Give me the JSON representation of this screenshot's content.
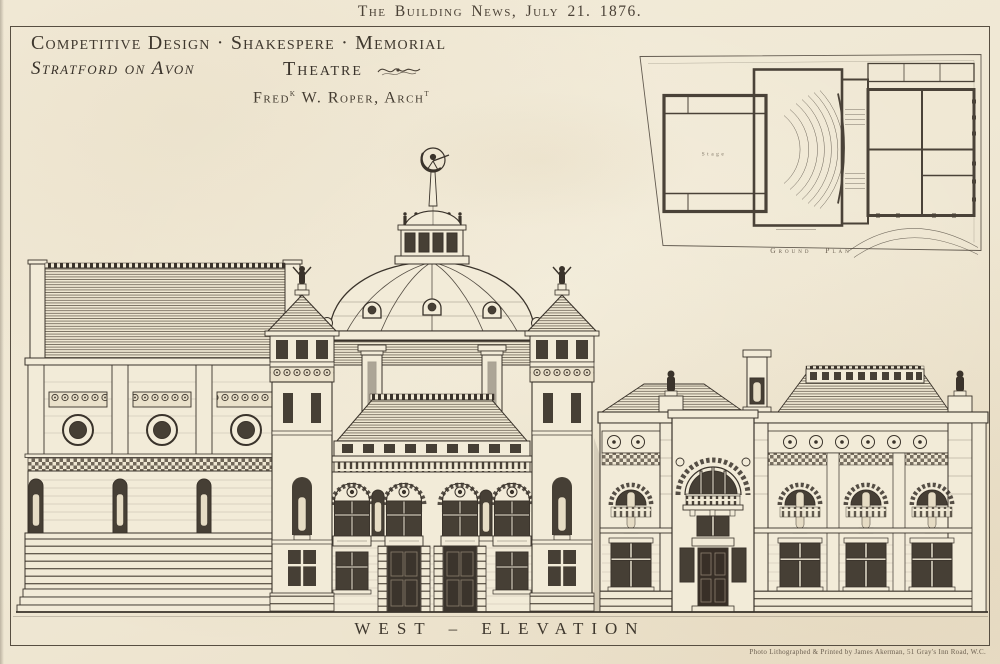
{
  "page": {
    "header": "The Building News, July 21. 1876.",
    "credit": "Photo Lithographed & Printed by James Akerman, 51 Gray's Inn Road, W.C."
  },
  "title_block": {
    "line1": "Competitive Design · Shakespere · Memorial",
    "place": "Stratford on Avon",
    "building": "Theatre",
    "architect": {
      "pre": "Fred",
      "sup1": "k",
      "mid": " W. Roper, Arch",
      "sup2": "t"
    }
  },
  "plan": {
    "label": "Ground Plan",
    "stage_label": "Stage"
  },
  "elevation": {
    "caption": "WEST – ELEVATION"
  },
  "colors": {
    "paper": "#f0e8d5",
    "ink": "#3a332b",
    "window_dark": "#463f35",
    "statue": "#e6dcc4"
  }
}
